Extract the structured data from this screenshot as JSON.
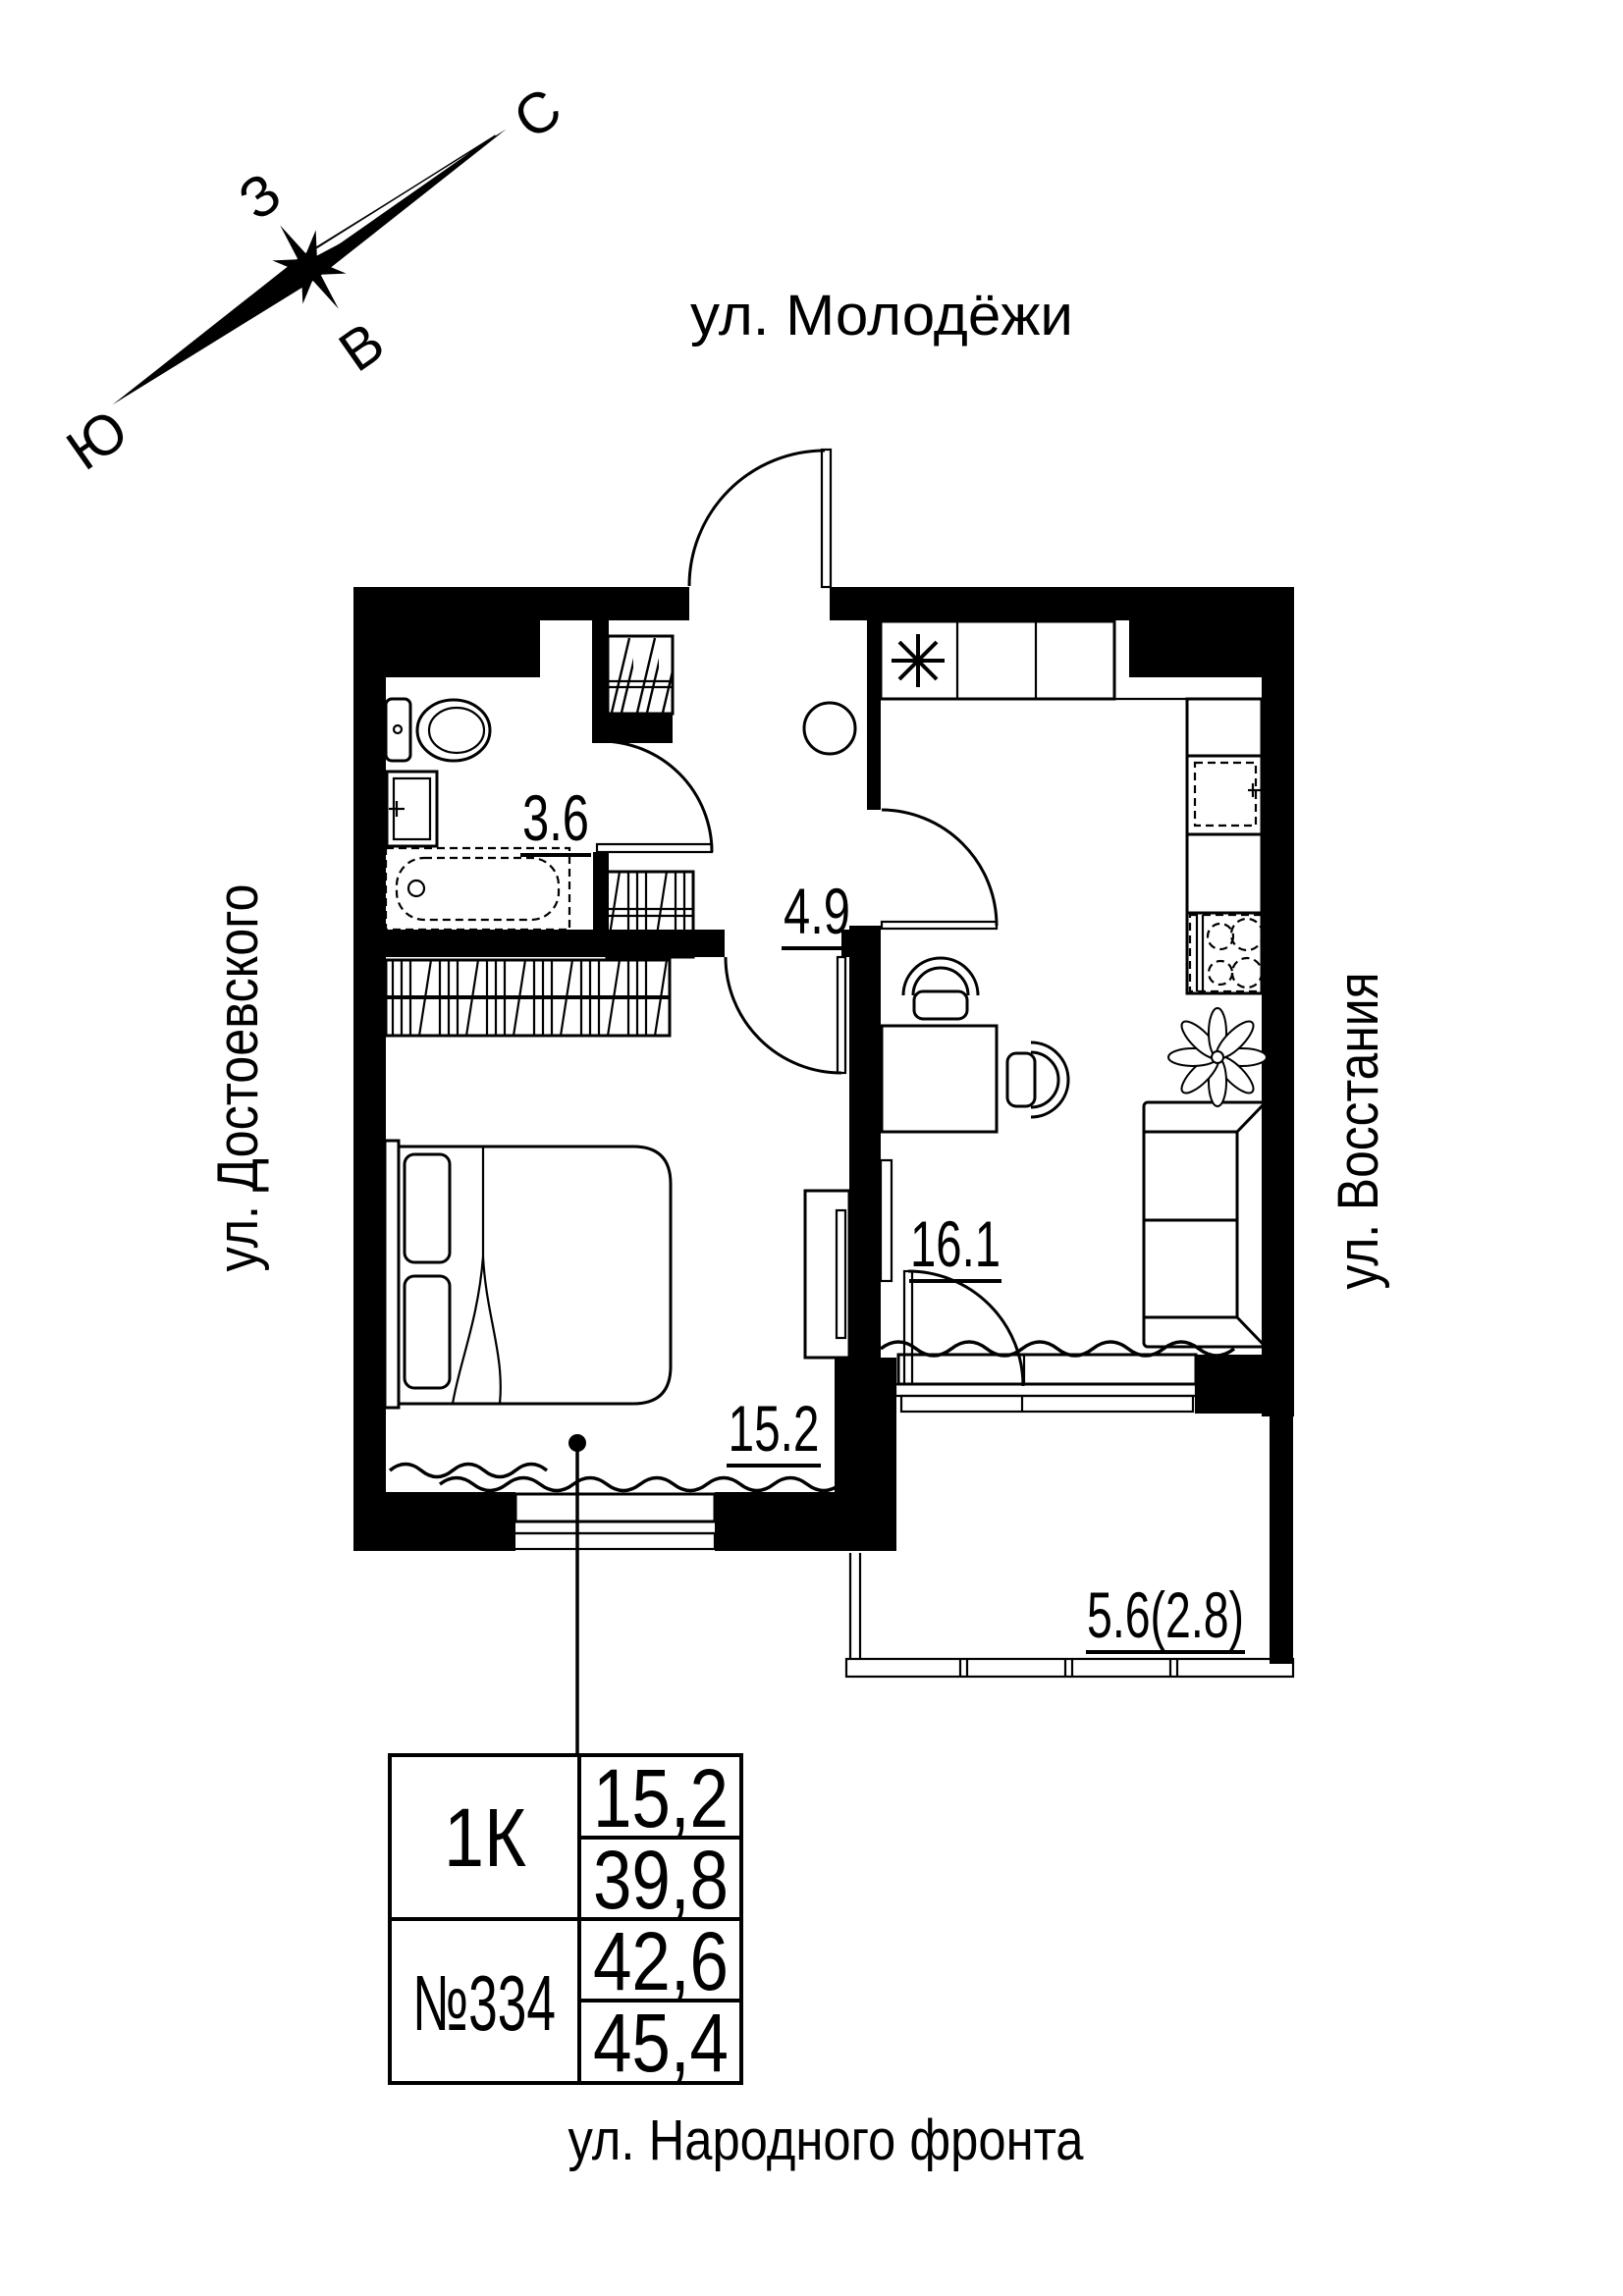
{
  "compass": {
    "north_label": "С",
    "west_label": "З",
    "east_label": "В",
    "south_label": "Ю"
  },
  "streets": {
    "top": "ул. Молодёжи",
    "left": "ул. Достоевского",
    "right": "ул. Восстания",
    "bottom": "ул. Народного фронта"
  },
  "plan_areas": {
    "bathroom": "3.6",
    "hallway": "4.9",
    "kitchen_living_room": "16.1",
    "bedroom": "15.2",
    "balcony": "5.6(2.8)"
  },
  "info_table": {
    "apartment_type": "1К",
    "apartment_number": "№334",
    "living_area": "15,2",
    "area_no_balcony": "39,8",
    "area_balcony_reduced": "42,6",
    "area_balcony_full": "45,4"
  },
  "colors": {
    "ink": "#000000",
    "background": "#ffffff"
  }
}
